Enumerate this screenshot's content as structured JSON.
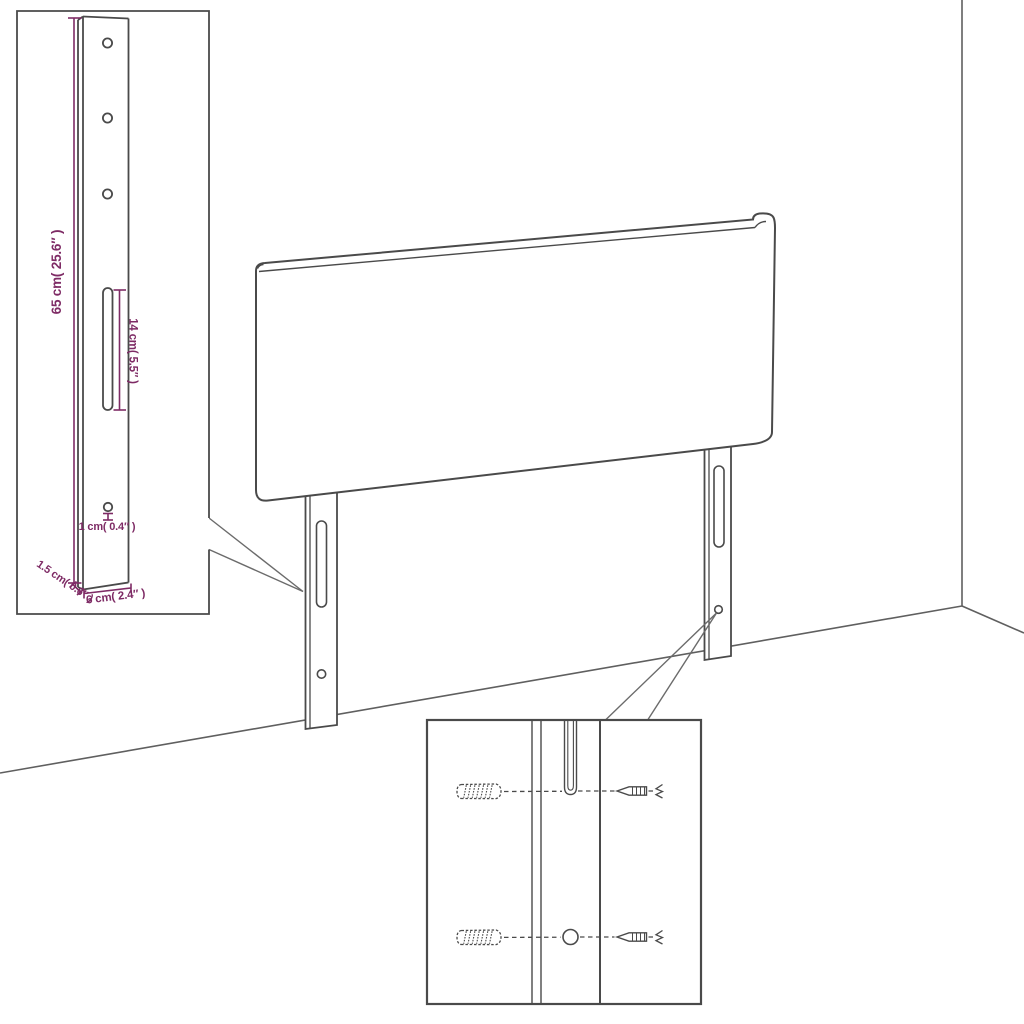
{
  "labels": {
    "leg_height": "65 cm( 25.6″ )",
    "slot_length": "14 cm( 5.5″ )",
    "hole_size": "1 cm( 0.4″ )",
    "leg_thickness": "1.5 cm( 0.6″ )",
    "leg_width": "6 cm( 2.4″ )"
  },
  "colors": {
    "line": "#4a4a4a",
    "wall_line": "#5f5f5f",
    "callout_line": "#6b6b6b",
    "dimension": "#7e2b65",
    "background": "#ffffff"
  }
}
